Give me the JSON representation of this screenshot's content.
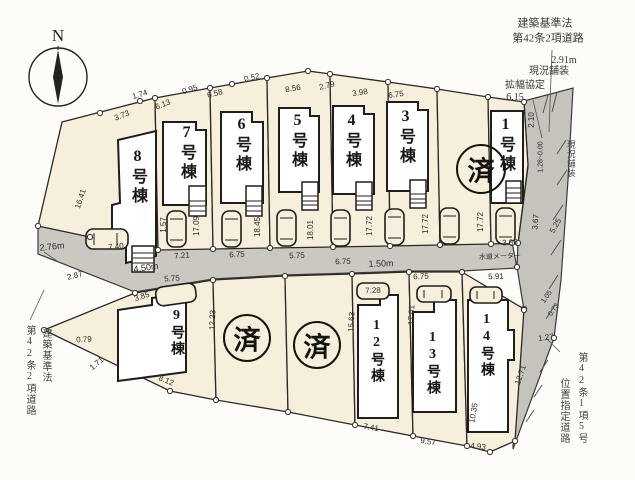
{
  "compass": {
    "label": "N"
  },
  "sold_stamp": "済",
  "colors": {
    "lot_fill": "#f6efdb",
    "road_fill": "#cbc8c2",
    "line": "#2a2925"
  },
  "lots": {
    "lot1": "1号棟",
    "lot3": "3号棟",
    "lot4": "4号棟",
    "lot5": "5号棟",
    "lot6": "6号棟",
    "lot7": "7号棟",
    "lot8": "8号棟",
    "lot9": "9号棟",
    "lot12": "12号棟",
    "lot13": "13号棟",
    "lot14": "14号棟"
  },
  "roads": {
    "left": {
      "width": "2.76m",
      "law1": "建築基準法",
      "law2": "第42条2項道路"
    },
    "center": {
      "width": "4.50m",
      "width2": "1.50m",
      "note": "水道メーター"
    },
    "right": {
      "law1": "建築基準法",
      "law2": "第42条2項道路",
      "width": "2.91m",
      "surface": "現況舗装",
      "widen": "拡幅協定",
      "widen_value": "6.15",
      "surface_v": "現況舗装"
    },
    "bottom_right": {
      "col1": "第42条1項5号",
      "col2": "位置指定道路"
    }
  },
  "dims": {
    "t1": "3.73",
    "t2": "1.74",
    "t3": "6.13",
    "t4": "0.95",
    "t5": "6.58",
    "t6": "0.52",
    "t7": "8.56",
    "t8": "2.79",
    "t9": "3.98",
    "t10": "6.75",
    "s7a": "1.57",
    "s7b": "17.09",
    "s6": "18.45",
    "s5": "18.01",
    "s4": "17.72",
    "s3": "17.72",
    "s2": "17.72",
    "r1": "2.10",
    "r2": "1.28~0.00",
    "r3": "3.67",
    "r4": "5.25",
    "r5": "3.85",
    "r6": "1.05",
    "r7": "0.73",
    "c1": "7.21",
    "c2": "6.75",
    "c3": "5.75",
    "c4": "6.75",
    "c5": "5.75",
    "c6": "6.75",
    "c7": "5.91",
    "c8": "7.28",
    "w1": "2.87",
    "w2": "0.79",
    "w3": "1.71",
    "w4": "16.41",
    "w5": "7.40",
    "b1": "3.85",
    "b2": "12.23",
    "b3": "15.63",
    "b4": "17.01",
    "b5": "10.35",
    "b6": "8.12",
    "b7": "7.41",
    "b8": "9.57",
    "b9": "4.93",
    "b10": "12.71",
    "b11": "1.27"
  }
}
